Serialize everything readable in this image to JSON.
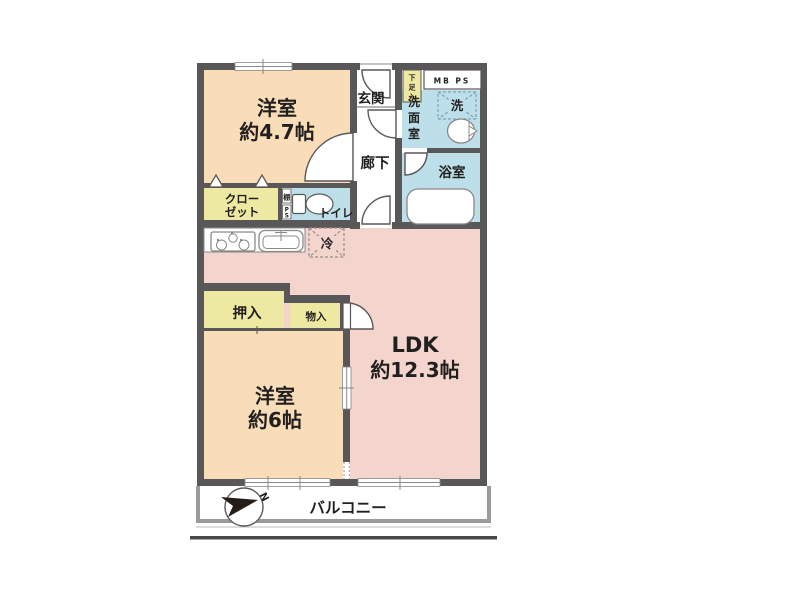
{
  "floor_plan": {
    "rooms": {
      "western_room_47": {
        "name": "洋室",
        "size": "約4.7帖"
      },
      "western_room_6": {
        "name": "洋室",
        "size": "約6帖"
      },
      "ldk": {
        "name": "LDK",
        "size": "約12.3帖"
      },
      "entrance": "玄関",
      "hallway": "廊下",
      "bathroom": "浴室",
      "toilet": "トイレ",
      "balcony": "バルコニー",
      "washroom_chars": {
        "c1": "洗",
        "c2": "面",
        "c3": "室"
      }
    },
    "storage": {
      "closet": {
        "line1": "クロー",
        "line2": "ゼット"
      },
      "futon_closet": "押入",
      "storage_box": "物入",
      "shoe_cabinet_chars": {
        "c1": "下",
        "c2": "足",
        "c3": "入"
      },
      "shelf": "棚",
      "pipe_space_chars": {
        "c1": "P",
        "c2": "S"
      }
    },
    "equipment": {
      "washer_space": "洗",
      "fridge_space": "冷",
      "meter_box": "MB PS"
    },
    "compass_north": "N",
    "colors": {
      "wall": "#595757",
      "room_peach": "#f8ddb8",
      "ldk_pink": "#f3d5cd",
      "water_blue": "#bcdfe9",
      "storage_yellow": "#ede9a2",
      "fixture_stroke": "#8a8888",
      "balcony_gray": "#9b9999",
      "ground_line": "#4a4848"
    }
  }
}
